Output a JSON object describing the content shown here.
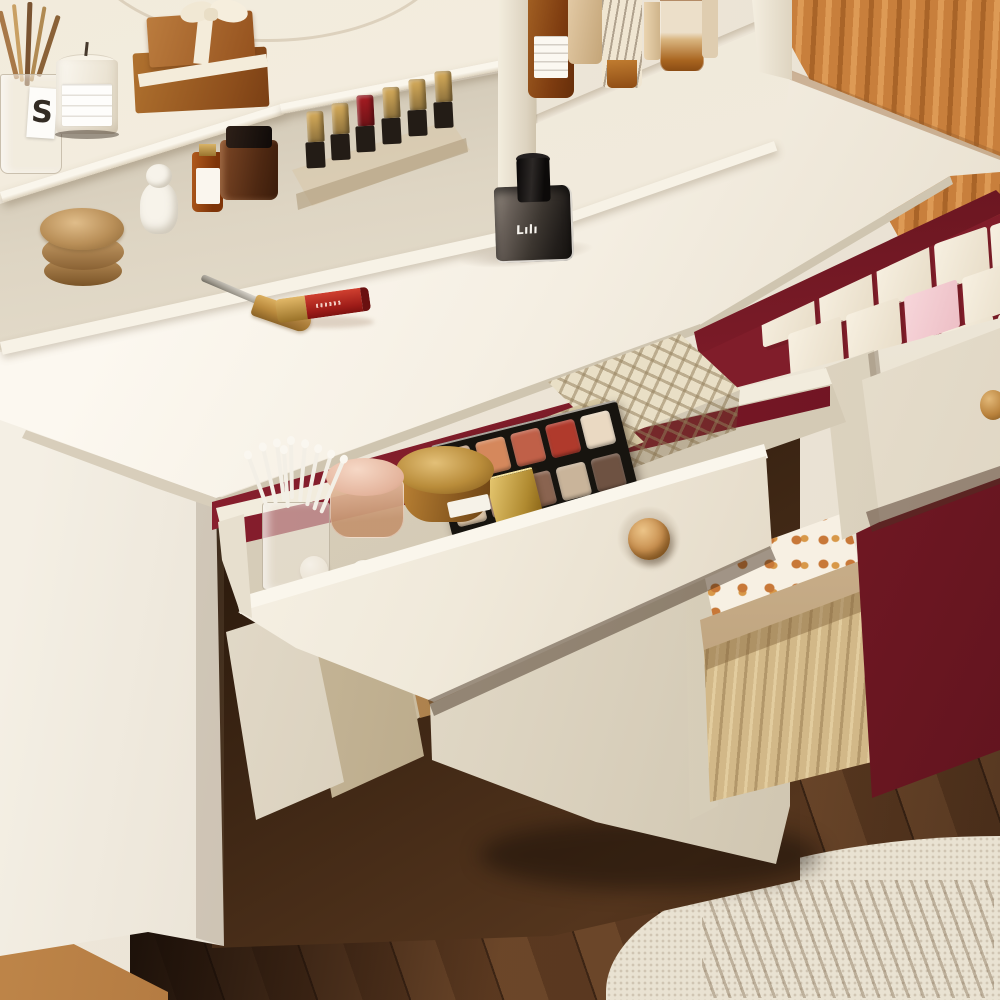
{
  "meta": {
    "domain": "Natural-Image",
    "subject": "White makeup vanity dressing table with hutch, open cosmetic drawers with burgundy lining, caramel fluted wall panel, dark hardwood floor and cream rug"
  },
  "texts": {
    "perfume_logo": "Lılı",
    "brush_cup_label": "S"
  },
  "colors": {
    "furniture_white": "#f4eee2",
    "drawer_lining_red": "#8e2130",
    "cabinet_door_red": "#7c1b27",
    "knob_wood": "#c89050",
    "wall_panel_caramel": "#c87f3c",
    "floor_wood": "#5a3820",
    "rug": "#e9e2d2",
    "gold_metal": "#b98f58"
  },
  "furniture": {
    "vanity_desk": {
      "material_color": "#f4eee2",
      "knob_color": "#c89050"
    },
    "hutch_shelves": {
      "color": "#f4eee2"
    },
    "open_drawer": {
      "state": "open",
      "lining": "#8e2130"
    },
    "right_drawer": {
      "state": "partially-open",
      "lining": "#801d2a"
    },
    "cabinet_door": {
      "color": "#7c1b27"
    }
  },
  "objects": {
    "top_shelf": {
      "brush_cup": {
        "label": "S",
        "contents": "makeup brushes"
      },
      "candle": {
        "wax": "#f7f2e6",
        "jar": "#fbf8f1"
      },
      "gift_boxes": {
        "color": "#9a5a24",
        "ribbon": "#f4ecda",
        "count": 2
      },
      "apothecary_bottle": {
        "color": "#7e3c10"
      },
      "striped_tube": {
        "color": "#f0e6d2"
      },
      "foundation_bottles": {
        "color": "#d9b580"
      }
    },
    "middle_shelf": {
      "gold_tins": {
        "color": "#b98f58",
        "count": 2
      },
      "figurine": {
        "color": "#f7f3ea"
      },
      "serum_bottle": {
        "color": "#b05a1c"
      },
      "amber_jar": {
        "color": "#4e2812"
      },
      "lipstick_rack": {
        "cap_colors": [
          "#d9ae5c",
          "#d9ae5c",
          "#a81c22",
          "#d9ae5c",
          "#d9ae5c",
          "#d9ae5c"
        ],
        "base_color": "#231c16",
        "count": 6
      }
    },
    "desktop_items": {
      "perfume_bottle": {
        "glass": "#3c3630",
        "cap": "#0c0a09",
        "logo": "Lılı"
      },
      "mascara_wand": {
        "handle": "#c9c4ba",
        "tip": "#b9893c"
      },
      "lip_gloss": {
        "body": "#b02420",
        "cap": "#d9ae5c"
      }
    },
    "drawer_items": {
      "eyeshadow_palette": {
        "case": "#17140f",
        "pan_colors": [
          "#c9a88c",
          "#d5885c",
          "#c06048",
          "#b03a2c",
          "#ead9c2",
          "#d9c3a6",
          "#a98878",
          "#8a6450",
          "#c9b49a",
          "#6e5242"
        ]
      },
      "gold_cream_jar": {
        "color": "#b98134"
      },
      "gold_compact": {
        "color": "#d9b45c"
      },
      "pink_powder_jar": {
        "lid": "#f0cdbb",
        "body": "#c89878"
      },
      "pearl_beads": {
        "color": "#f6f2ea",
        "count": 14
      },
      "cotton_swabs": {
        "color": "#f3efe6",
        "count": 9
      },
      "plaid_boxes": {
        "pattern": "lattice",
        "color": "#e9dfc6",
        "count": 2
      },
      "pink_trays": {
        "color": "#f6dedd"
      }
    },
    "right_drawer_items": {
      "tile_blocks": {
        "color": "#f1e8d8",
        "accent_color": "#f3ccd0",
        "count": 14,
        "pink_index": 7
      }
    },
    "lower_storage": {
      "polka_dot_box": {
        "base": "#f7f0e3",
        "dots": "#c87838"
      },
      "corrugated_box": {
        "color": "#d2b888"
      },
      "paper_bags": {
        "colors": [
          "#efe8da",
          "#d9cbb0"
        ],
        "count": 3
      }
    }
  }
}
